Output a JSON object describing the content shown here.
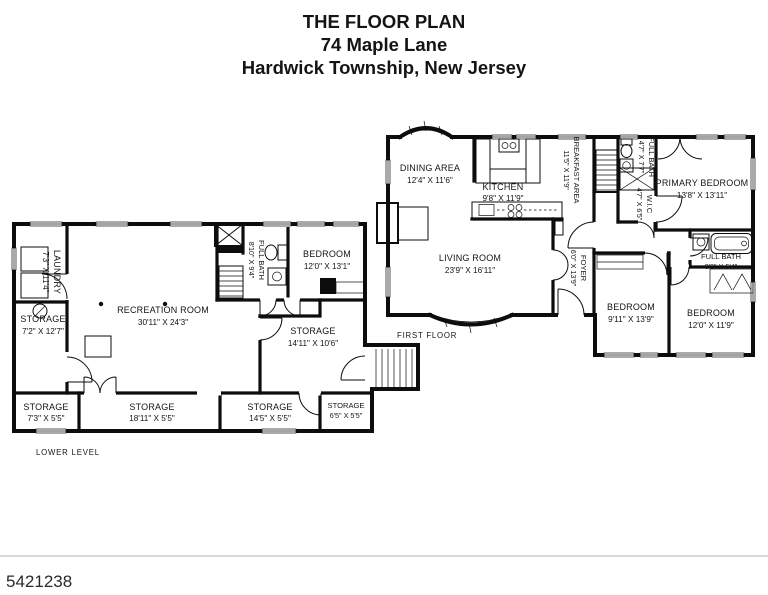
{
  "title": {
    "line1": "THE FLOOR PLAN",
    "line2": "74 Maple Lane",
    "line3": "Hardwick Township, New Jersey"
  },
  "floors": {
    "first": {
      "label": "FIRST FLOOR"
    },
    "lower": {
      "label": "LOWER LEVEL"
    }
  },
  "lower_rooms": {
    "laundry": {
      "name": "LAUNDRY",
      "dims": "7'3\" X 11'4\""
    },
    "storage_left": {
      "name": "STORAGE",
      "dims": "7'2\" X 12'7\""
    },
    "recreation": {
      "name": "RECREATION ROOM",
      "dims": "30'11\" X 24'3\""
    },
    "full_bath": {
      "name": "FULL BATH",
      "dims": "8'10\" X 9'4\""
    },
    "bedroom": {
      "name": "BEDROOM",
      "dims": "12'0\" X 13'1\""
    },
    "storage_mid": {
      "name": "STORAGE",
      "dims": "14'11\" X 10'6\""
    },
    "storage_b1": {
      "name": "STORAGE",
      "dims": "7'3\" X 5'5\""
    },
    "storage_b2": {
      "name": "STORAGE",
      "dims": "18'11\" X 5'5\""
    },
    "storage_b3": {
      "name": "STORAGE",
      "dims": "14'5\" X 5'5\""
    },
    "storage_b4": {
      "name": "STORAGE",
      "dims": "6'5\" X 5'5\""
    }
  },
  "first_rooms": {
    "dining": {
      "name": "DINING AREA",
      "dims": "12'4\" X 11'6\""
    },
    "kitchen": {
      "name": "KITCHEN",
      "dims": "9'8\" X 11'9\""
    },
    "breakfast": {
      "name": "BREAKFAST AREA",
      "dims": "11'5\" X 11'9\""
    },
    "living": {
      "name": "LIVING ROOM",
      "dims": "23'9\" X 16'11\""
    },
    "foyer": {
      "name": "FOYER",
      "dims": "6'0\" X 13'9\""
    },
    "full_bath_upper": {
      "name": "FULL BATH",
      "dims": "4'7\" X 7'7\""
    },
    "wic": {
      "name": "W.I.C",
      "dims": "4'7\" X 6'5\""
    },
    "primary_bedroom": {
      "name": "PRIMARY BEDROOM",
      "dims": "13'8\" X 13'11\""
    },
    "bedroom_a": {
      "name": "BEDROOM",
      "dims": "9'11\" X 13'9\""
    },
    "bedroom_b": {
      "name": "BEDROOM",
      "dims": "12'0\" X 11'9\""
    },
    "full_bath_hall": {
      "name": "FULL BATH",
      "dims": "8'0\" X 5'4\""
    }
  },
  "footer": {
    "photo_id": "5421238"
  },
  "colors": {
    "ink": "#0d0d0d",
    "paper": "#ffffff"
  }
}
